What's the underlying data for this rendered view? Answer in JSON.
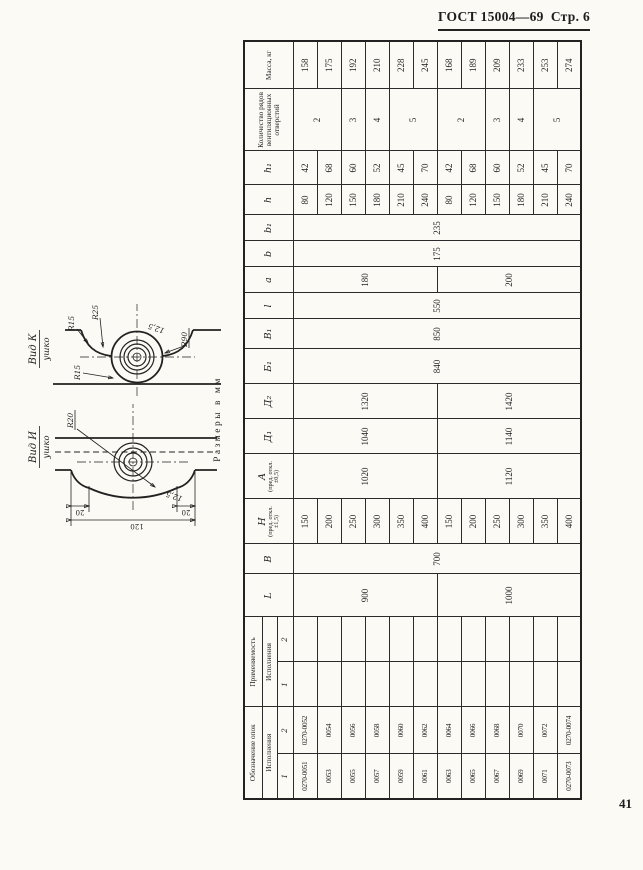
{
  "page": {
    "header": "ГОСТ 15004—69",
    "page_label": "Стр. 6",
    "page_number": "41",
    "units_note": "Размеры в мм"
  },
  "fig_i": {
    "title": "Вид И",
    "subtitle": "ушко",
    "r20": "R20",
    "angle": "12,5",
    "dim_flank_top": "20",
    "dim_flank_bottom": "20",
    "dim_overall": "120"
  },
  "fig_k": {
    "title": "Вид К",
    "subtitle": "ушко",
    "r15a": "R15",
    "r25": "R25",
    "r15b": "R15",
    "angle": "12,5",
    "r90": "R90"
  },
  "table": {
    "row_count": 12,
    "groups": [
      {
        "label": "Обозначение опок",
        "sub": "Исполнения",
        "cols": [
          "1",
          "2"
        ]
      },
      {
        "label": "Применяемость",
        "sub": "Исполнения",
        "cols": [
          "1",
          "2"
        ]
      }
    ],
    "columns": [
      {
        "label": "L",
        "note": ""
      },
      {
        "label": "В",
        "note": ""
      },
      {
        "label": "Н",
        "note": "(пред. откл. ±1,5)"
      },
      {
        "label": "А",
        "note": "(пред. откл. ±0,5)"
      },
      {
        "label": "Д₁",
        "note": ""
      },
      {
        "label": "Д₂",
        "note": ""
      },
      {
        "label": "Б₁",
        "note": ""
      },
      {
        "label": "В₁",
        "note": ""
      },
      {
        "label": "l",
        "note": ""
      },
      {
        "label": "a",
        "note": ""
      },
      {
        "label": "b",
        "note": ""
      },
      {
        "label": "b₁",
        "note": ""
      },
      {
        "label": "h",
        "note": ""
      },
      {
        "label": "h₁",
        "note": ""
      },
      {
        "label": "Количество рядов вентиляционных отверстий",
        "note": ""
      },
      {
        "label": "Масса, кг",
        "note": ""
      }
    ],
    "body_columns": [
      {
        "key": "designation_1",
        "cls": "small",
        "cells": [
          "0270-0051",
          "0053",
          "0055",
          "0057",
          "0059",
          "0061",
          "0063",
          "0065",
          "0067",
          "0069",
          "0071",
          "0270-0073"
        ]
      },
      {
        "key": "designation_2",
        "cls": "small",
        "cells": [
          "0270-0052",
          "0054",
          "0056",
          "0058",
          "0060",
          "0062",
          "0064",
          "0066",
          "0068",
          "0070",
          "0072",
          "0270-0074"
        ]
      },
      {
        "key": "applicability_1",
        "cells": [
          "",
          "",
          "",
          "",
          "",
          "",
          "",
          "",
          "",
          "",
          "",
          ""
        ]
      },
      {
        "key": "applicability_2",
        "cells": [
          "",
          "",
          "",
          "",
          "",
          "",
          "",
          "",
          "",
          "",
          "",
          ""
        ]
      },
      {
        "key": "L",
        "cells": [
          {
            "v": "900",
            "span": 6
          },
          {
            "v": "1000",
            "span": 6
          }
        ]
      },
      {
        "key": "B",
        "cells": [
          {
            "v": "700",
            "span": 12
          }
        ]
      },
      {
        "key": "H",
        "cells": [
          "150",
          "200",
          "250",
          "300",
          "350",
          "400",
          "150",
          "200",
          "250",
          "300",
          "350",
          "400"
        ]
      },
      {
        "key": "A",
        "cells": [
          {
            "v": "1020",
            "span": 6
          },
          {
            "v": "1120",
            "span": 6
          }
        ]
      },
      {
        "key": "D1",
        "cells": [
          {
            "v": "1040",
            "span": 6
          },
          {
            "v": "1140",
            "span": 6
          }
        ]
      },
      {
        "key": "D2",
        "cells": [
          {
            "v": "1320",
            "span": 6
          },
          {
            "v": "1420",
            "span": 6
          }
        ]
      },
      {
        "key": "B1",
        "cells": [
          {
            "v": "840",
            "span": 12
          }
        ]
      },
      {
        "key": "V1",
        "cells": [
          {
            "v": "850",
            "span": 12
          }
        ]
      },
      {
        "key": "l",
        "cells": [
          {
            "v": "550",
            "span": 12
          }
        ]
      },
      {
        "key": "a",
        "cells": [
          {
            "v": "180",
            "span": 6
          },
          {
            "v": "200",
            "span": 6
          }
        ]
      },
      {
        "key": "b",
        "cells": [
          {
            "v": "175",
            "span": 12
          }
        ]
      },
      {
        "key": "b1",
        "cells": [
          {
            "v": "235",
            "span": 12
          }
        ]
      },
      {
        "key": "h",
        "cells": [
          "80",
          "120",
          "150",
          "180",
          "210",
          "240",
          "80",
          "120",
          "150",
          "180",
          "210",
          "240"
        ]
      },
      {
        "key": "h1",
        "cells": [
          "42",
          "68",
          "60",
          "52",
          "45",
          "70",
          "42",
          "68",
          "60",
          "52",
          "45",
          "70"
        ]
      },
      {
        "key": "vent_rows",
        "cells": [
          {
            "v": "2",
            "span": 2
          },
          "3",
          "4",
          {
            "v": "5",
            "span": 2
          },
          {
            "v": "2",
            "span": 2
          },
          "3",
          "4",
          {
            "v": "5",
            "span": 2
          }
        ]
      },
      {
        "key": "mass",
        "cells": [
          "158",
          "175",
          "192",
          "210",
          "228",
          "245",
          "168",
          "189",
          "209",
          "233",
          "253",
          "274"
        ]
      }
    ]
  }
}
